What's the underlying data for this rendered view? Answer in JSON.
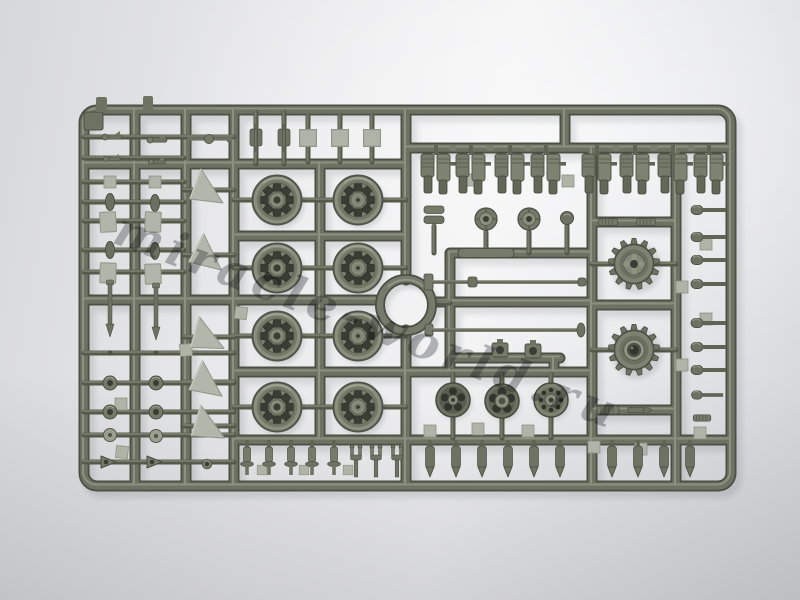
{
  "scene": {
    "description": "Top-down photograph of an injection-molded styrene sprue (parts tree) from a scale model tank kit: road wheels, drive sprockets, shock absorbers and small fittings in olive-grey plastic on a light grey studio background",
    "plastic_color": "#6e7363",
    "plastic_dark": "#4b4f44",
    "plastic_highlight": "#a9ad9d",
    "flat_part_color": "#b3b6ab",
    "background_color": "#e8e9eb"
  },
  "watermark": {
    "text": "miracle-world.ru"
  },
  "parts_inventory": [
    {
      "name": "road-wheel",
      "count": 8
    },
    {
      "name": "drive-sprocket",
      "count": 2
    },
    {
      "name": "circular-ring",
      "count": 1
    },
    {
      "name": "shock-absorber",
      "count": 8
    },
    {
      "name": "wheel-hub",
      "count": 3
    },
    {
      "name": "triangular-wedge",
      "count": 5
    },
    {
      "name": "torsion-bar-rod",
      "count": 2
    },
    {
      "name": "round-head-peg",
      "count": 8
    },
    {
      "name": "bullet-peg",
      "count": 10
    },
    {
      "name": "clevis-shackle",
      "count": 8
    },
    {
      "name": "small-fitting",
      "count": 40
    }
  ]
}
